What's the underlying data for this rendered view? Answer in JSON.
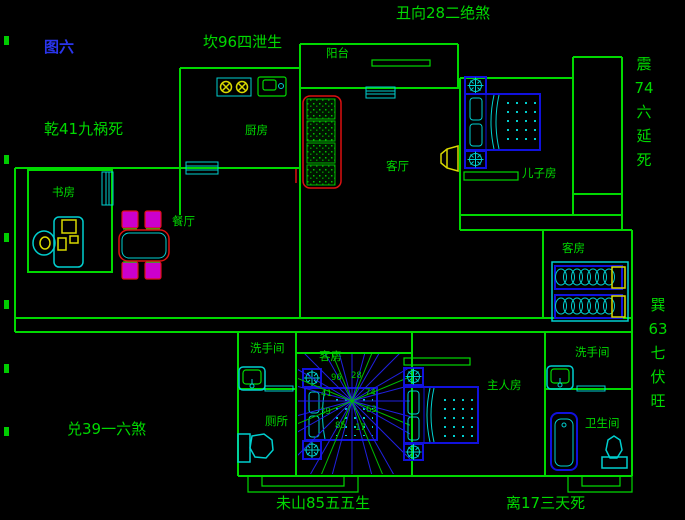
{
  "figure_title": "图六",
  "perimeter_labels": {
    "top_left": "坎96四泄生",
    "top_center": "丑向28二绝煞",
    "left_upper": "乾41九祸死",
    "left_lower": "兑39一六煞",
    "right_upper_vertical": "震\n74\n六\n延\n死",
    "right_lower_vertical": "巽\n63\n七\n伏\n旺",
    "bottom_left": "未山85五五生",
    "bottom_right": "离17三天死"
  },
  "room_labels": {
    "balcony": "阳台",
    "kitchen": "厨房",
    "living_room": "客厅",
    "son_room": "儿子房",
    "study": "书房",
    "dining": "餐厅",
    "guest_room_right": "客房",
    "guest_room_center": "客房",
    "washroom_left": "洗手间",
    "toilet": "厕所",
    "master_room": "主人房",
    "washroom_right": "洗手间",
    "bathroom": "卫生间"
  },
  "compass_numbers": {
    "k96": "96",
    "k28": "28",
    "k74": "74",
    "k63": "63",
    "k17": "17",
    "k85": "85",
    "k39": "39",
    "k41": "41"
  },
  "colors": {
    "background": "#000000",
    "wall_green": "#00d900",
    "text_green": "#00d900",
    "title_blue": "#2a35ee",
    "furniture_blue": "#1111dd",
    "detail_cyan": "#00cfcf",
    "accent_yellow": "#d9d900",
    "accent_red": "#dd1111",
    "accent_magenta": "#cc00cc"
  }
}
